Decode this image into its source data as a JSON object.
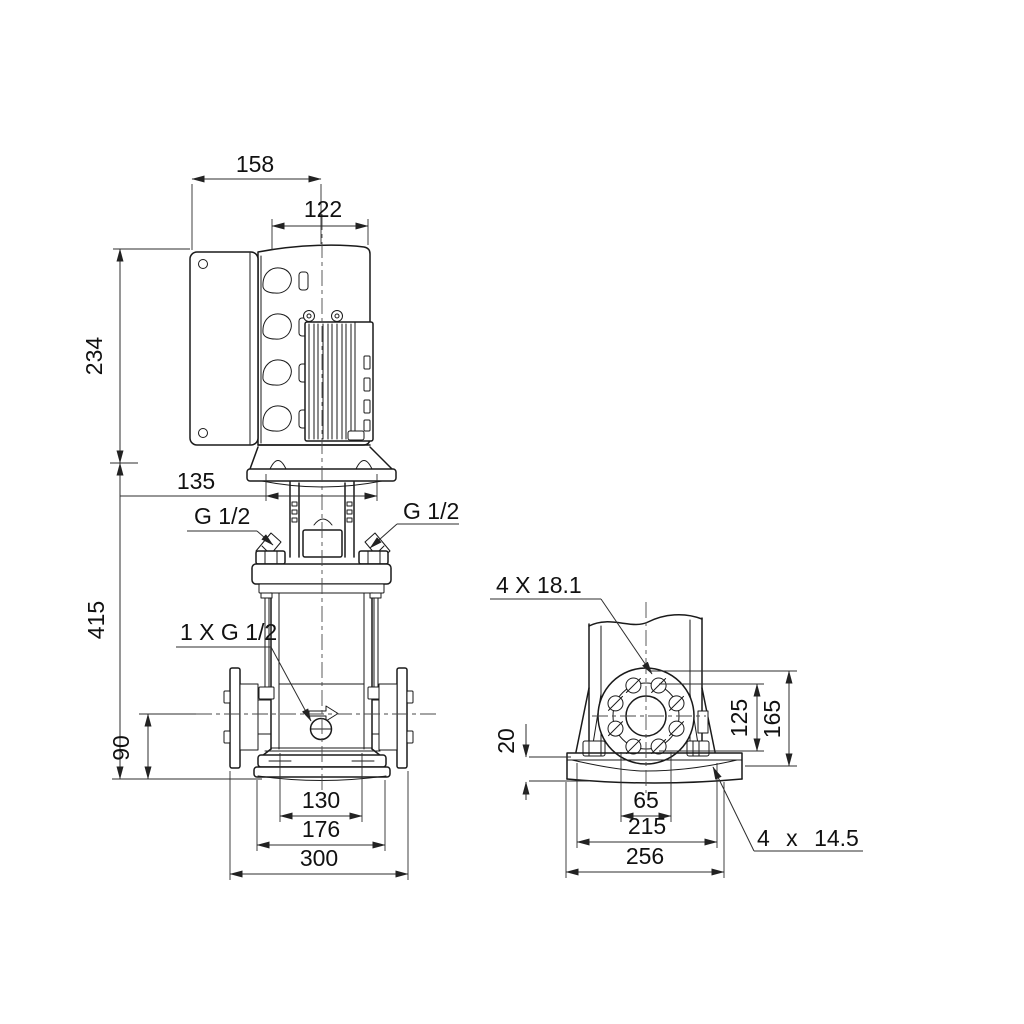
{
  "palette": {
    "background": "#ffffff",
    "line": "#1a1a1a",
    "dim_line": "#2e2e2e",
    "text": "#111111"
  },
  "front_view": {
    "dims": {
      "control_box_width": "158",
      "motor_width": "122",
      "motor_height": "234",
      "head_width": "135",
      "pump_height": "415",
      "port_height": "90",
      "chamber_width": "130",
      "base_width": "176",
      "port_to_port": "300"
    },
    "labels": {
      "vent_plug_left": "G 1/2",
      "vent_plug_right": "G 1/2",
      "drain_plug": "1 X G 1/2"
    }
  },
  "side_view": {
    "dims": {
      "bolt_circle_height": "125",
      "flange_top_height": "165",
      "base_plate_thickness": "20",
      "flange_hole_pitch": "65",
      "base_hole_pitch": "215",
      "base_depth": "256"
    },
    "labels": {
      "flange_holes": "4 X 18.1",
      "base_plate_holes": "4 x 14.5"
    }
  }
}
